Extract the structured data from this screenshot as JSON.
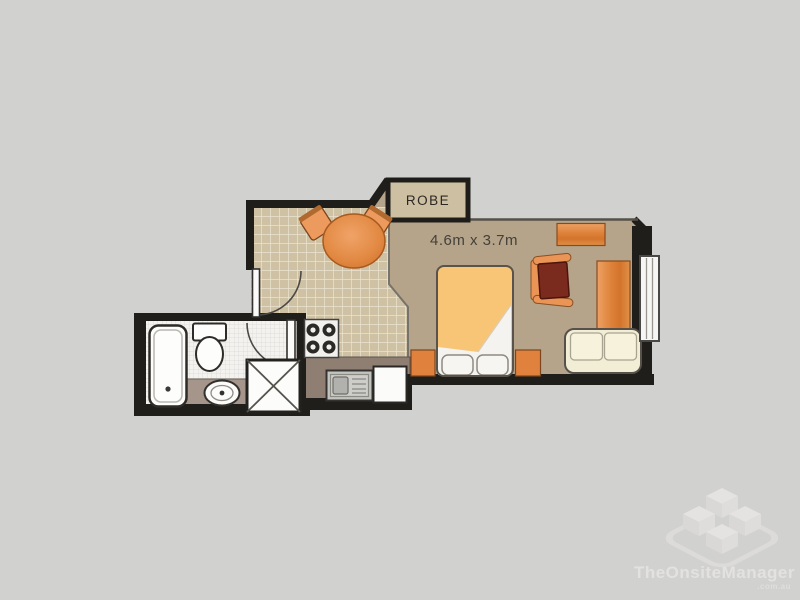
{
  "floor_plan": {
    "robe": {
      "label": "ROBE"
    },
    "main_room": {
      "dimensions": "4.6m x 3.7m"
    },
    "fixtures": [
      "bathtub",
      "toilet",
      "basin",
      "shower",
      "stove",
      "sink",
      "bench",
      "dining-table",
      "dining-chairs",
      "bed",
      "nightstands",
      "armchair",
      "desk",
      "side-table",
      "sofa",
      "window",
      "entry-door",
      "bathroom-door",
      "robe-closet"
    ]
  },
  "watermark": {
    "brand": "TheOnsiteManager",
    "domain": ".com.au"
  },
  "colors": {
    "background": "#d1d1cf",
    "wall": "#201e1b",
    "thin_wall": "#55514a",
    "carpet": "#b5a489",
    "kitchen_tile": "#cfc1a3",
    "tile_line": "#ebe4d1",
    "bath_floor": "#f3f2ef",
    "counter": "#8f7f73",
    "vanity": "#a5958a",
    "wood_orange": "#e0823e",
    "bed_spread": "#f8c577",
    "sheet_white": "#f4f3ef",
    "sofa_cream": "#f2eed6",
    "armchair_maroon": "#7b2b1d",
    "robe_fill": "#cdbfa1"
  }
}
